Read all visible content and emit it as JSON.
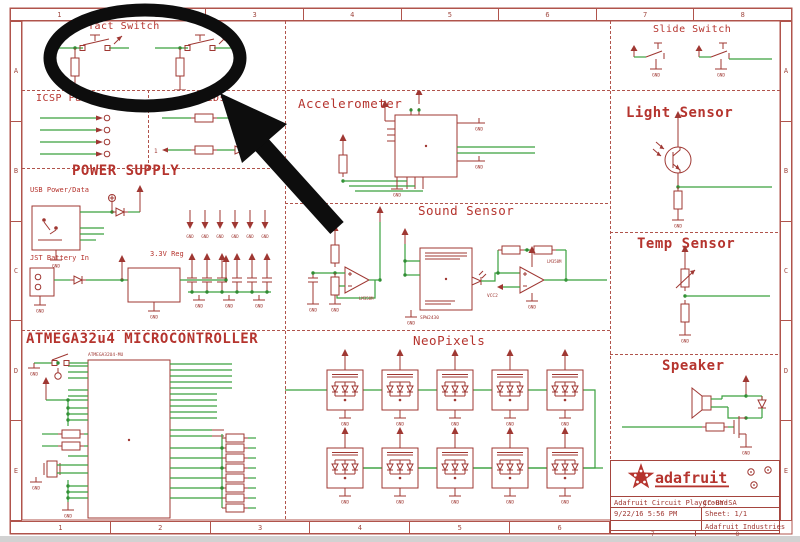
{
  "frame": {
    "columns": [
      "1",
      "2",
      "3",
      "4",
      "5",
      "6",
      "7",
      "8"
    ],
    "rows": [
      "A",
      "B",
      "C",
      "D",
      "E"
    ]
  },
  "labels": {
    "gnd": "GND",
    "vcc": "VCC",
    "vcc2": "VCC2",
    "led_pin": "1"
  },
  "sections": {
    "tact_switch": {
      "title": "Tact Switch"
    },
    "icsp_pads": {
      "title": "ICSP Pads"
    },
    "leds": {
      "title": "LEDs"
    },
    "power_supply": {
      "title": "POWER SUPPLY",
      "usb": "USB Power/Data",
      "jst": "JST Battery In",
      "reg": "3.3V Reg"
    },
    "microcontroller": {
      "title": "ATMEGA32u4 MICROCONTROLLER",
      "chip": "ATMEGA32U4-MU"
    },
    "accelerometer": {
      "title": "Accelerometer"
    },
    "sound_sensor": {
      "title": "Sound Sensor",
      "opamp": "LM358M",
      "mic": "SPW2430"
    },
    "neopixels": {
      "title": "NeoPixels"
    },
    "slide_switch": {
      "title": "Slide Switch"
    },
    "light_sensor": {
      "title": "Light Sensor"
    },
    "temp_sensor": {
      "title": "Temp Sensor"
    },
    "speaker": {
      "title": "Speaker"
    }
  },
  "title_block": {
    "logo": "adafruit",
    "project": "Adafruit Circuit Playground",
    "license": "CC-BY-SA",
    "date": "9/22/16 5:56 PM",
    "sheet": "Sheet: 1/1",
    "company": "Adafruit Industries"
  },
  "colors": {
    "schematic_red": "#9f3732",
    "wire_green": "#3aa13e",
    "title_red": "#b5342e",
    "annotation_black": "#0d0d0d"
  }
}
